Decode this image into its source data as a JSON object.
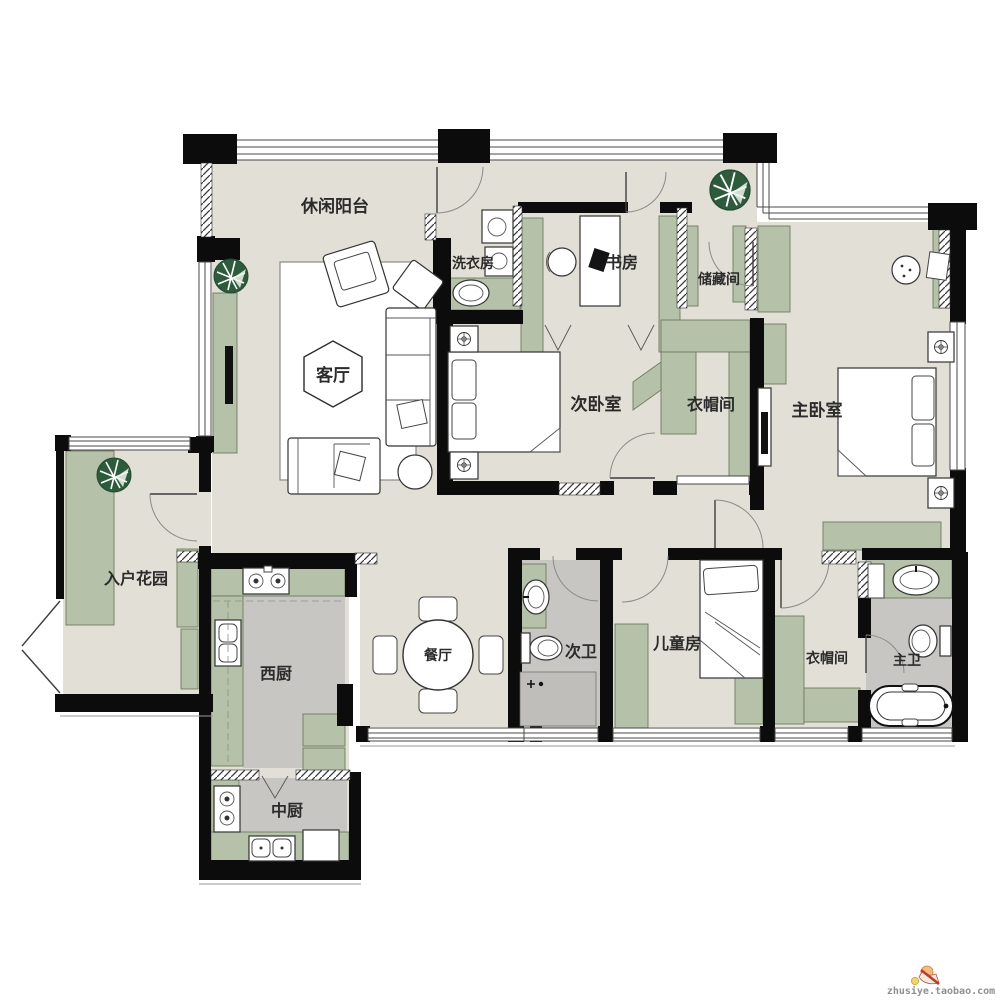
{
  "plan_title": "apartment-floor-plan",
  "rooms": [
    {
      "id": "leisure-balcony",
      "label": "休闲阳台"
    },
    {
      "id": "laundry-room",
      "label": "洗衣房"
    },
    {
      "id": "study",
      "label": "书房"
    },
    {
      "id": "storage-room",
      "label": "储藏间"
    },
    {
      "id": "living-room",
      "label": "客厅"
    },
    {
      "id": "second-bedroom",
      "label": "次卧室"
    },
    {
      "id": "cloakroom-north",
      "label": "衣帽间"
    },
    {
      "id": "master-bedroom",
      "label": "主卧室"
    },
    {
      "id": "entry-garden",
      "label": "入户花园"
    },
    {
      "id": "west-kitchen",
      "label": "西厨"
    },
    {
      "id": "dining-room",
      "label": "餐厅"
    },
    {
      "id": "second-bathroom",
      "label": "次卫"
    },
    {
      "id": "kids-room",
      "label": "儿童房"
    },
    {
      "id": "cloakroom-south",
      "label": "衣帽间"
    },
    {
      "id": "master-bathroom",
      "label": "主卫"
    },
    {
      "id": "chinese-kitchen",
      "label": "中厨"
    }
  ],
  "watermark": {
    "text": "zhusiye.taobao.com"
  },
  "colors": {
    "wall": "#0c0c0c",
    "floor": "#e2dfd6",
    "wet_floor": "#c7c6c2",
    "cabinet_green": "#b5c1a8",
    "plant_green": "#2d5b3c"
  }
}
